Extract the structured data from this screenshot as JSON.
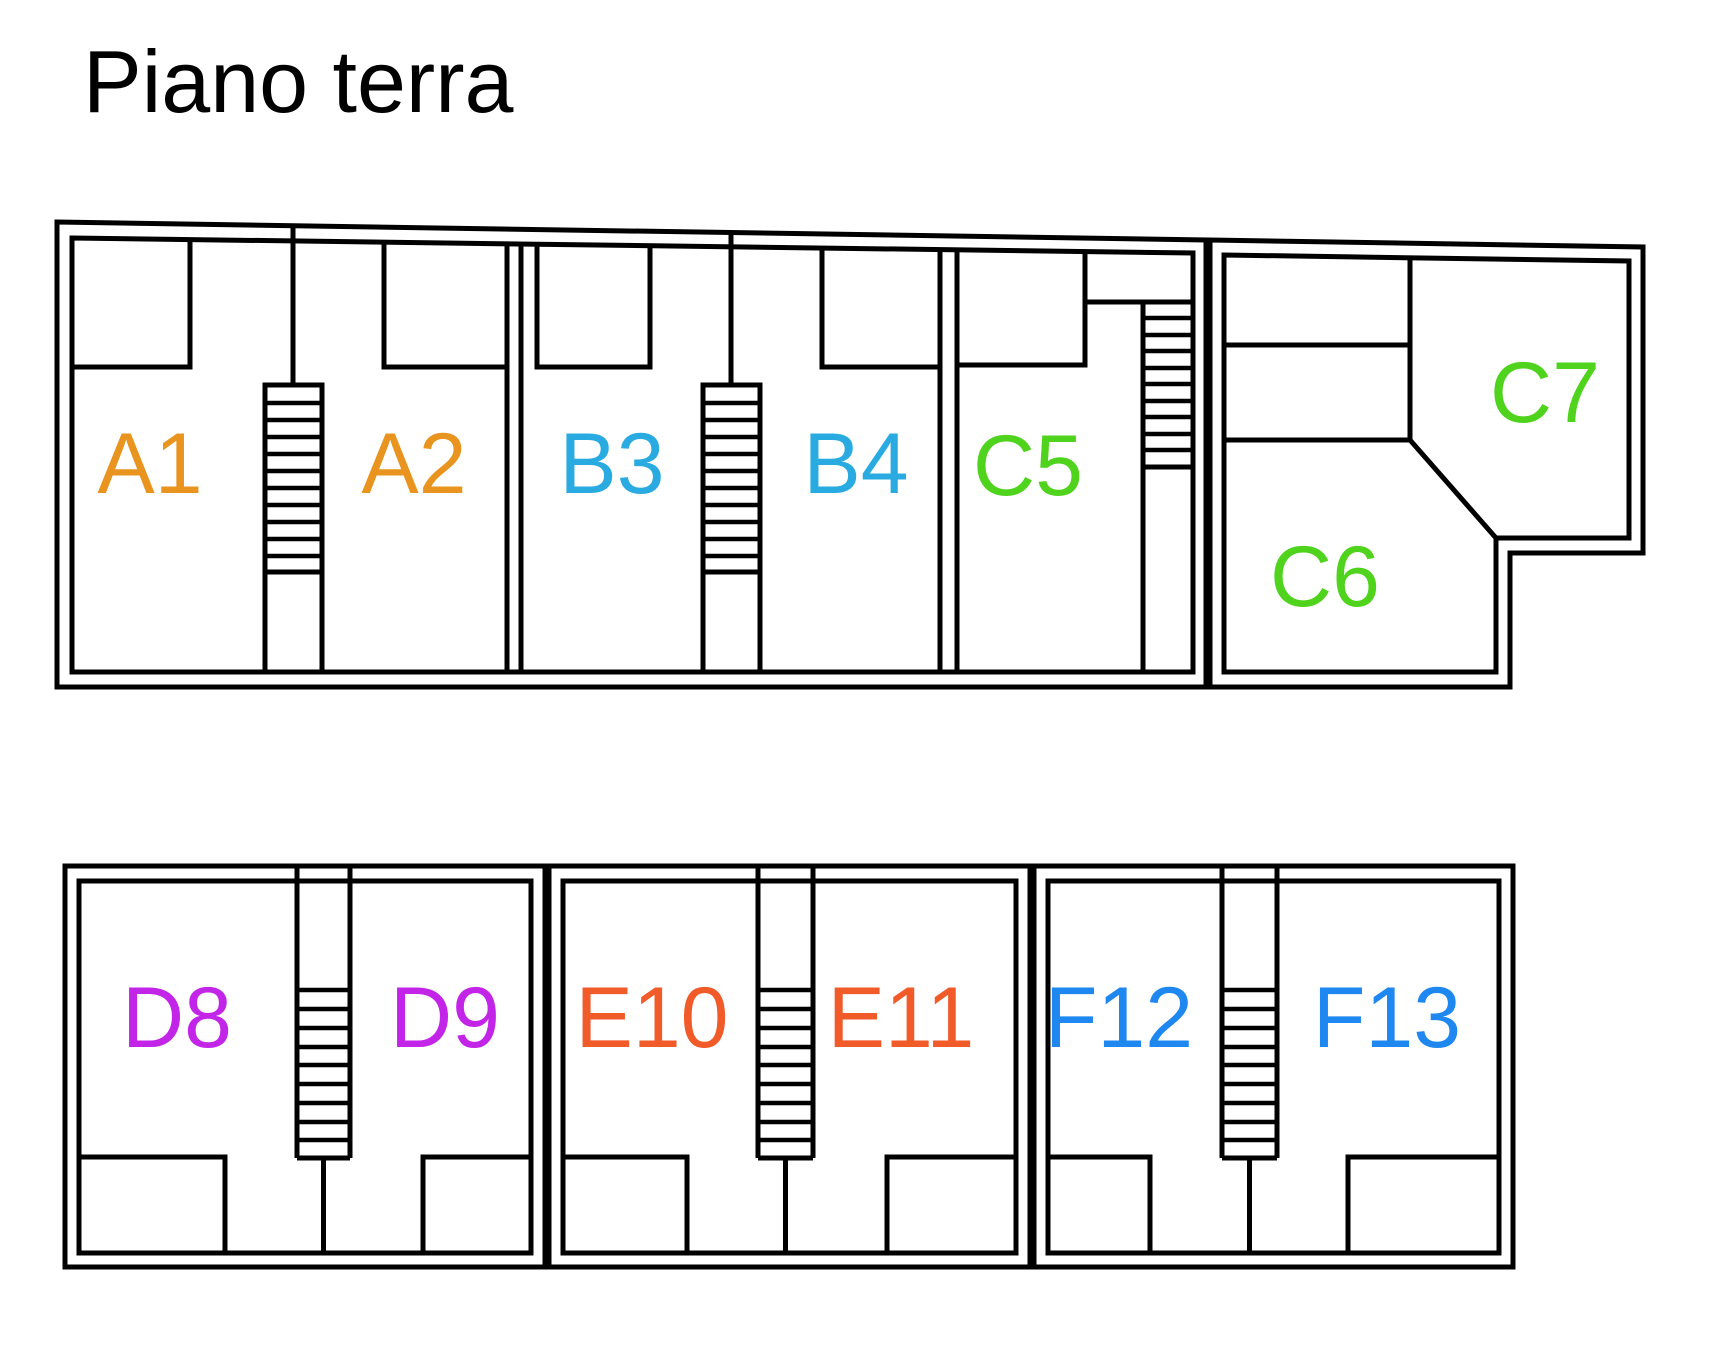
{
  "page": {
    "title": "Piano terra",
    "background": "#FFFFFF",
    "wall_color": "#000000"
  },
  "units": [
    {
      "id": "A1",
      "label": "A1",
      "color": "#E8941F",
      "building": "top",
      "feature": "staircase shared with A2"
    },
    {
      "id": "A2",
      "label": "A2",
      "color": "#E8941F",
      "building": "top",
      "feature": "staircase shared with A1"
    },
    {
      "id": "B3",
      "label": "B3",
      "color": "#29ABE2",
      "building": "top",
      "feature": "staircase shared with B4"
    },
    {
      "id": "B4",
      "label": "B4",
      "color": "#29ABE2",
      "building": "top",
      "feature": "staircase shared with B3"
    },
    {
      "id": "C5",
      "label": "C5",
      "color": "#4FD31D",
      "building": "top",
      "feature": "staircase at right side"
    },
    {
      "id": "C6",
      "label": "C6",
      "color": "#4FD31D",
      "building": "top-right-wing",
      "feature": "room with chamfered corner"
    },
    {
      "id": "C7",
      "label": "C7",
      "color": "#4FD31D",
      "building": "top-right-wing",
      "feature": "corner room"
    },
    {
      "id": "D8",
      "label": "D8",
      "color": "#C325E8",
      "building": "bottom",
      "feature": "staircase shared with D9"
    },
    {
      "id": "D9",
      "label": "D9",
      "color": "#C325E8",
      "building": "bottom",
      "feature": "staircase shared with D8"
    },
    {
      "id": "E10",
      "label": "E10",
      "color": "#F15A29",
      "building": "bottom",
      "feature": "staircase shared with E11"
    },
    {
      "id": "E11",
      "label": "E11",
      "color": "#F15A29",
      "building": "bottom",
      "feature": "staircase shared with E10"
    },
    {
      "id": "F12",
      "label": "F12",
      "color": "#1E87F0",
      "building": "bottom",
      "feature": "staircase shared with F13"
    },
    {
      "id": "F13",
      "label": "F13",
      "color": "#1E87F0",
      "building": "bottom",
      "feature": "staircase shared with F12"
    }
  ]
}
